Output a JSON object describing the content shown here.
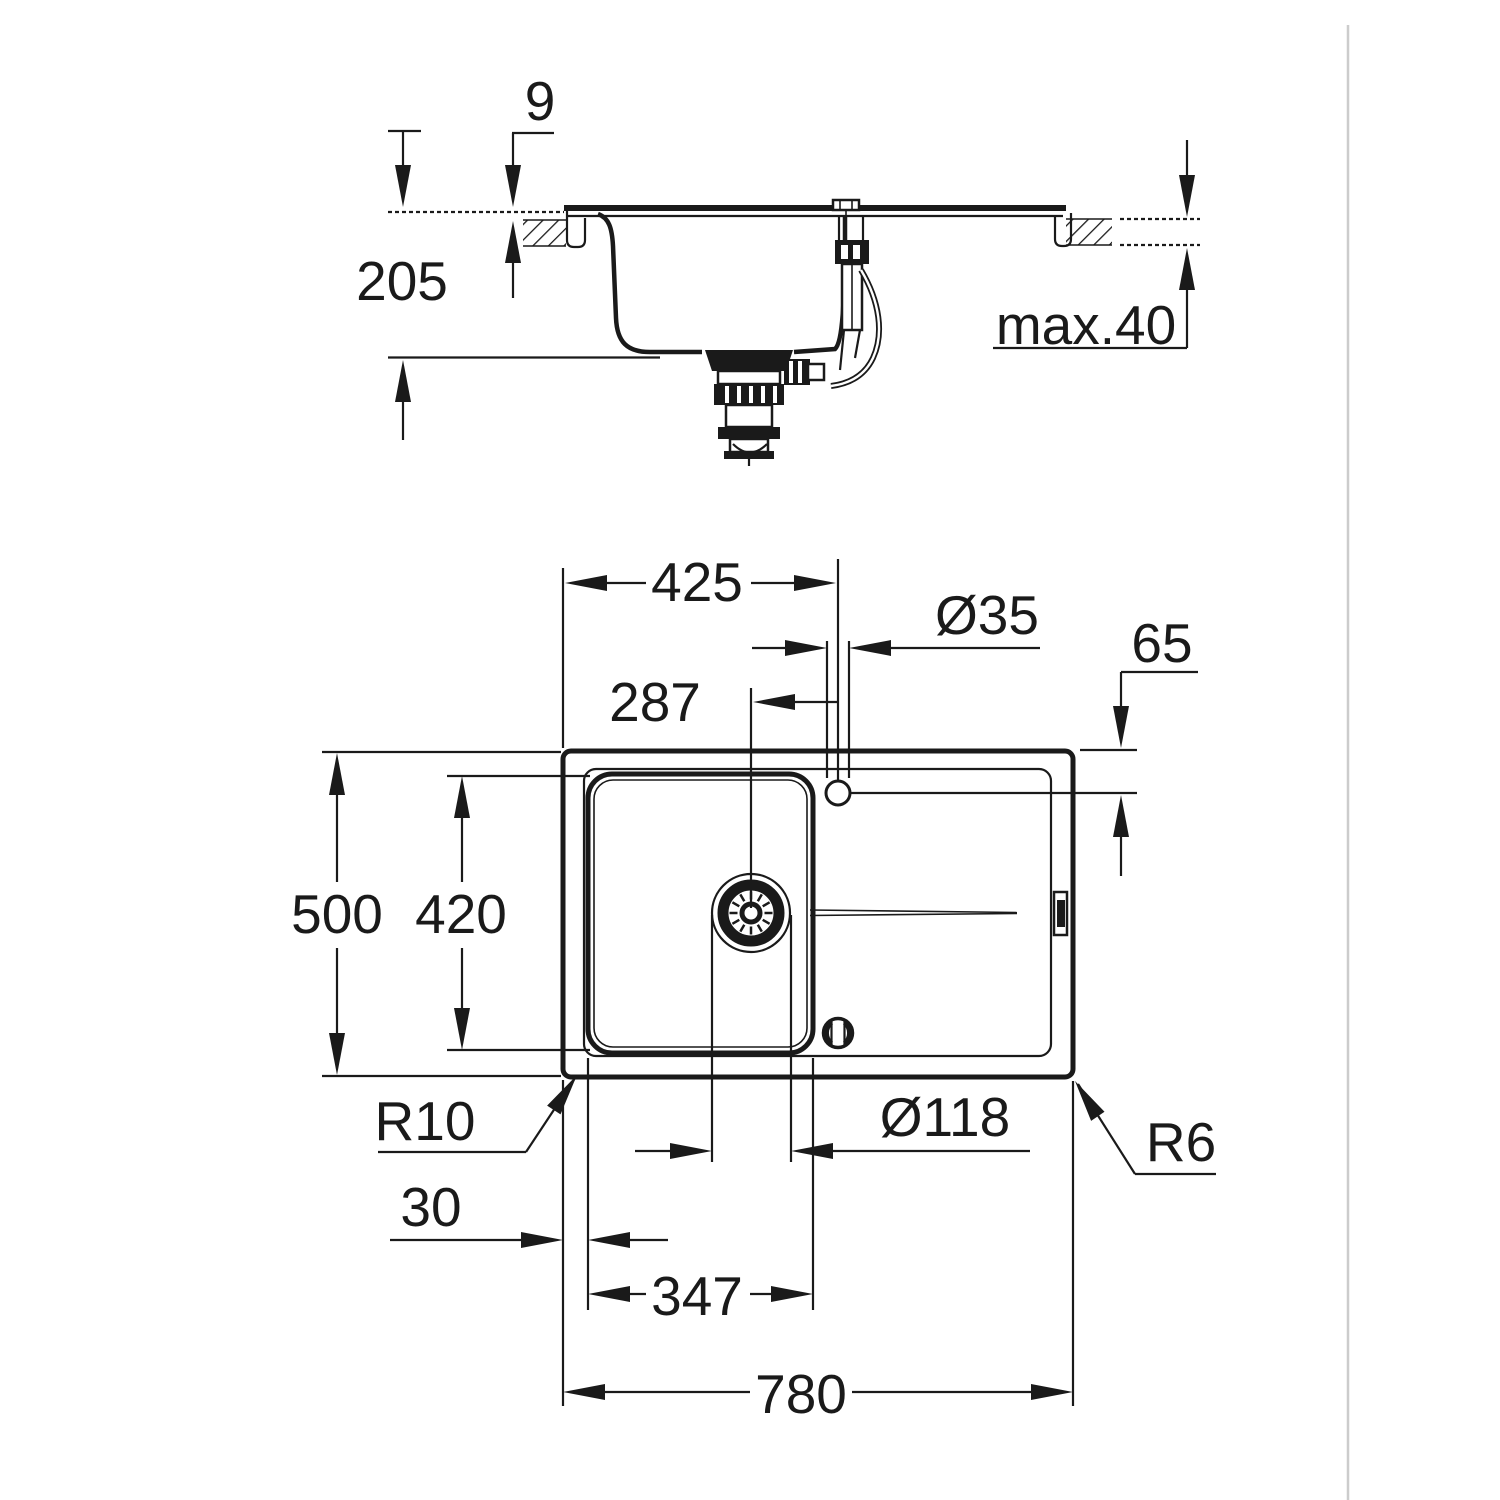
{
  "page": {
    "background": "#ffffff",
    "line_color": "#1a1a1a",
    "right_divider_color": "#cccccc"
  },
  "drawing": {
    "type": "technical-dimension-drawing",
    "subject": "inset kitchen sink with drainer, section and plan views",
    "views": {
      "section": {
        "name": "front-section-view",
        "dims": {
          "rim_height": "9",
          "bowl_depth": "205",
          "worktop_thickness": "max.40"
        }
      },
      "plan": {
        "name": "top-plan-view",
        "dims": {
          "faucet_center_from_left": "425",
          "faucet_hole_diameter": "Ø35",
          "faucet_center_from_top_edge": "65",
          "drain_center_to_faucet": "287",
          "overall_depth": "500",
          "bowl_inner_depth": "420",
          "bowl_corner_radius": "R10",
          "drain_diameter": "Ø118",
          "outer_corner_radius": "R6",
          "edge_to_bowl": "30",
          "bowl_inner_width": "347",
          "overall_width": "780"
        }
      }
    }
  }
}
